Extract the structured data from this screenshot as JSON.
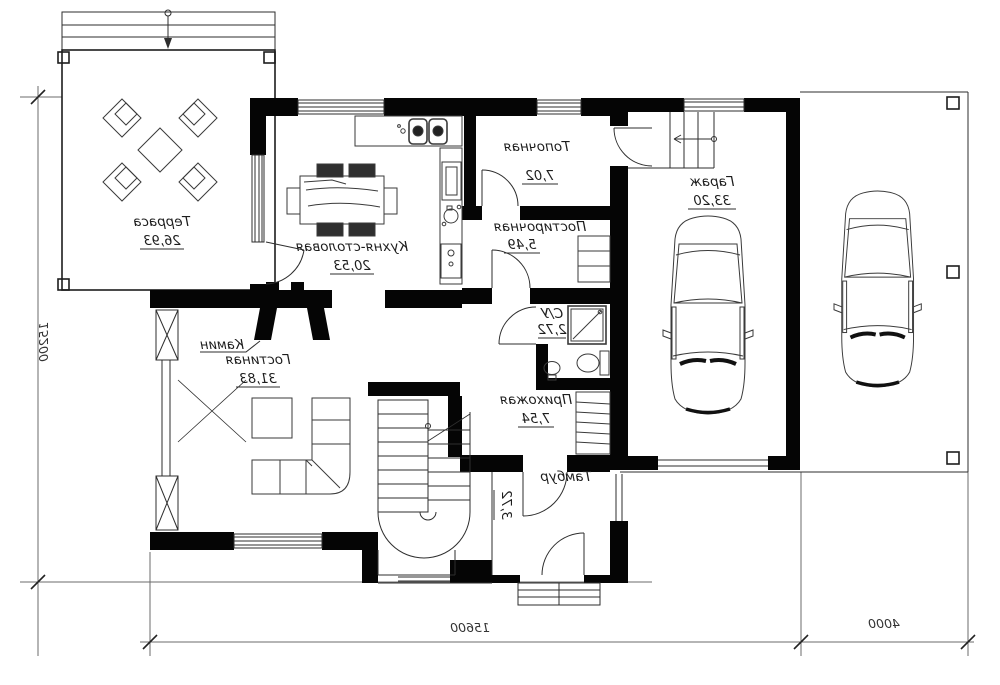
{
  "plan": {
    "title": "floor-plan",
    "rooms": {
      "terrace": {
        "name": "Терраса",
        "area": "26,93"
      },
      "kitchen": {
        "name": "Кухня-столовая",
        "area": "20,53"
      },
      "boiler": {
        "name": "Топочная",
        "area": "7,02"
      },
      "laundry": {
        "name": "Постирочная",
        "area": "5,49"
      },
      "garage": {
        "name": "Гараж",
        "area": "33,20"
      },
      "living": {
        "name": "Гостиная",
        "area": "31,83"
      },
      "wc": {
        "name": "С/У",
        "area": "2,72"
      },
      "hall": {
        "name": "Прихожая",
        "area": "7,54"
      },
      "tambour": {
        "name": "Тамбур",
        "area": "3,72"
      }
    },
    "labels": {
      "fireplace": "Камин"
    },
    "dimensions": {
      "left_side": "15200",
      "bottom_main": "15600",
      "bottom_right": "4000"
    },
    "colors": {
      "walls": "#050505",
      "lines": "#2e2e2e",
      "dimension_lines": "#6b6b6b",
      "background": "#ffffff"
    }
  }
}
